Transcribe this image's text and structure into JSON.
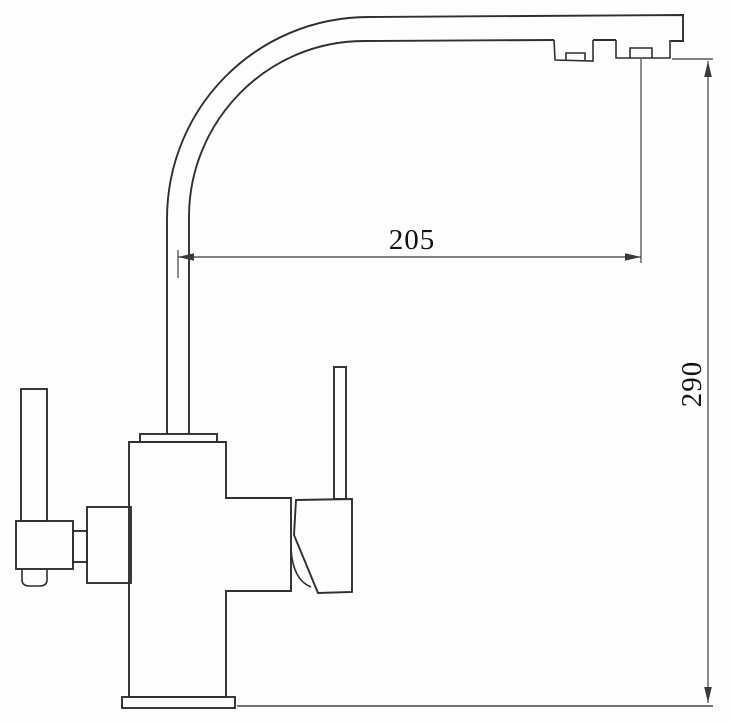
{
  "drawing": {
    "type": "technical-dimension-drawing",
    "subject": "two-handle kitchen faucet, side elevation with curved high-arc spout",
    "background_color": "#fdfdfd",
    "outline_color": "#2f2f2f",
    "dimension_color": "#3a3a3a",
    "text_color": "#111111",
    "dimensions": {
      "spout_reach": {
        "value": "205",
        "orientation": "horizontal",
        "measured_between": "spout riser centerline and aerator outlet centerline"
      },
      "spout_height": {
        "value": "290",
        "orientation": "vertical",
        "measured_between": "mounting surface and spout outlet"
      }
    }
  }
}
